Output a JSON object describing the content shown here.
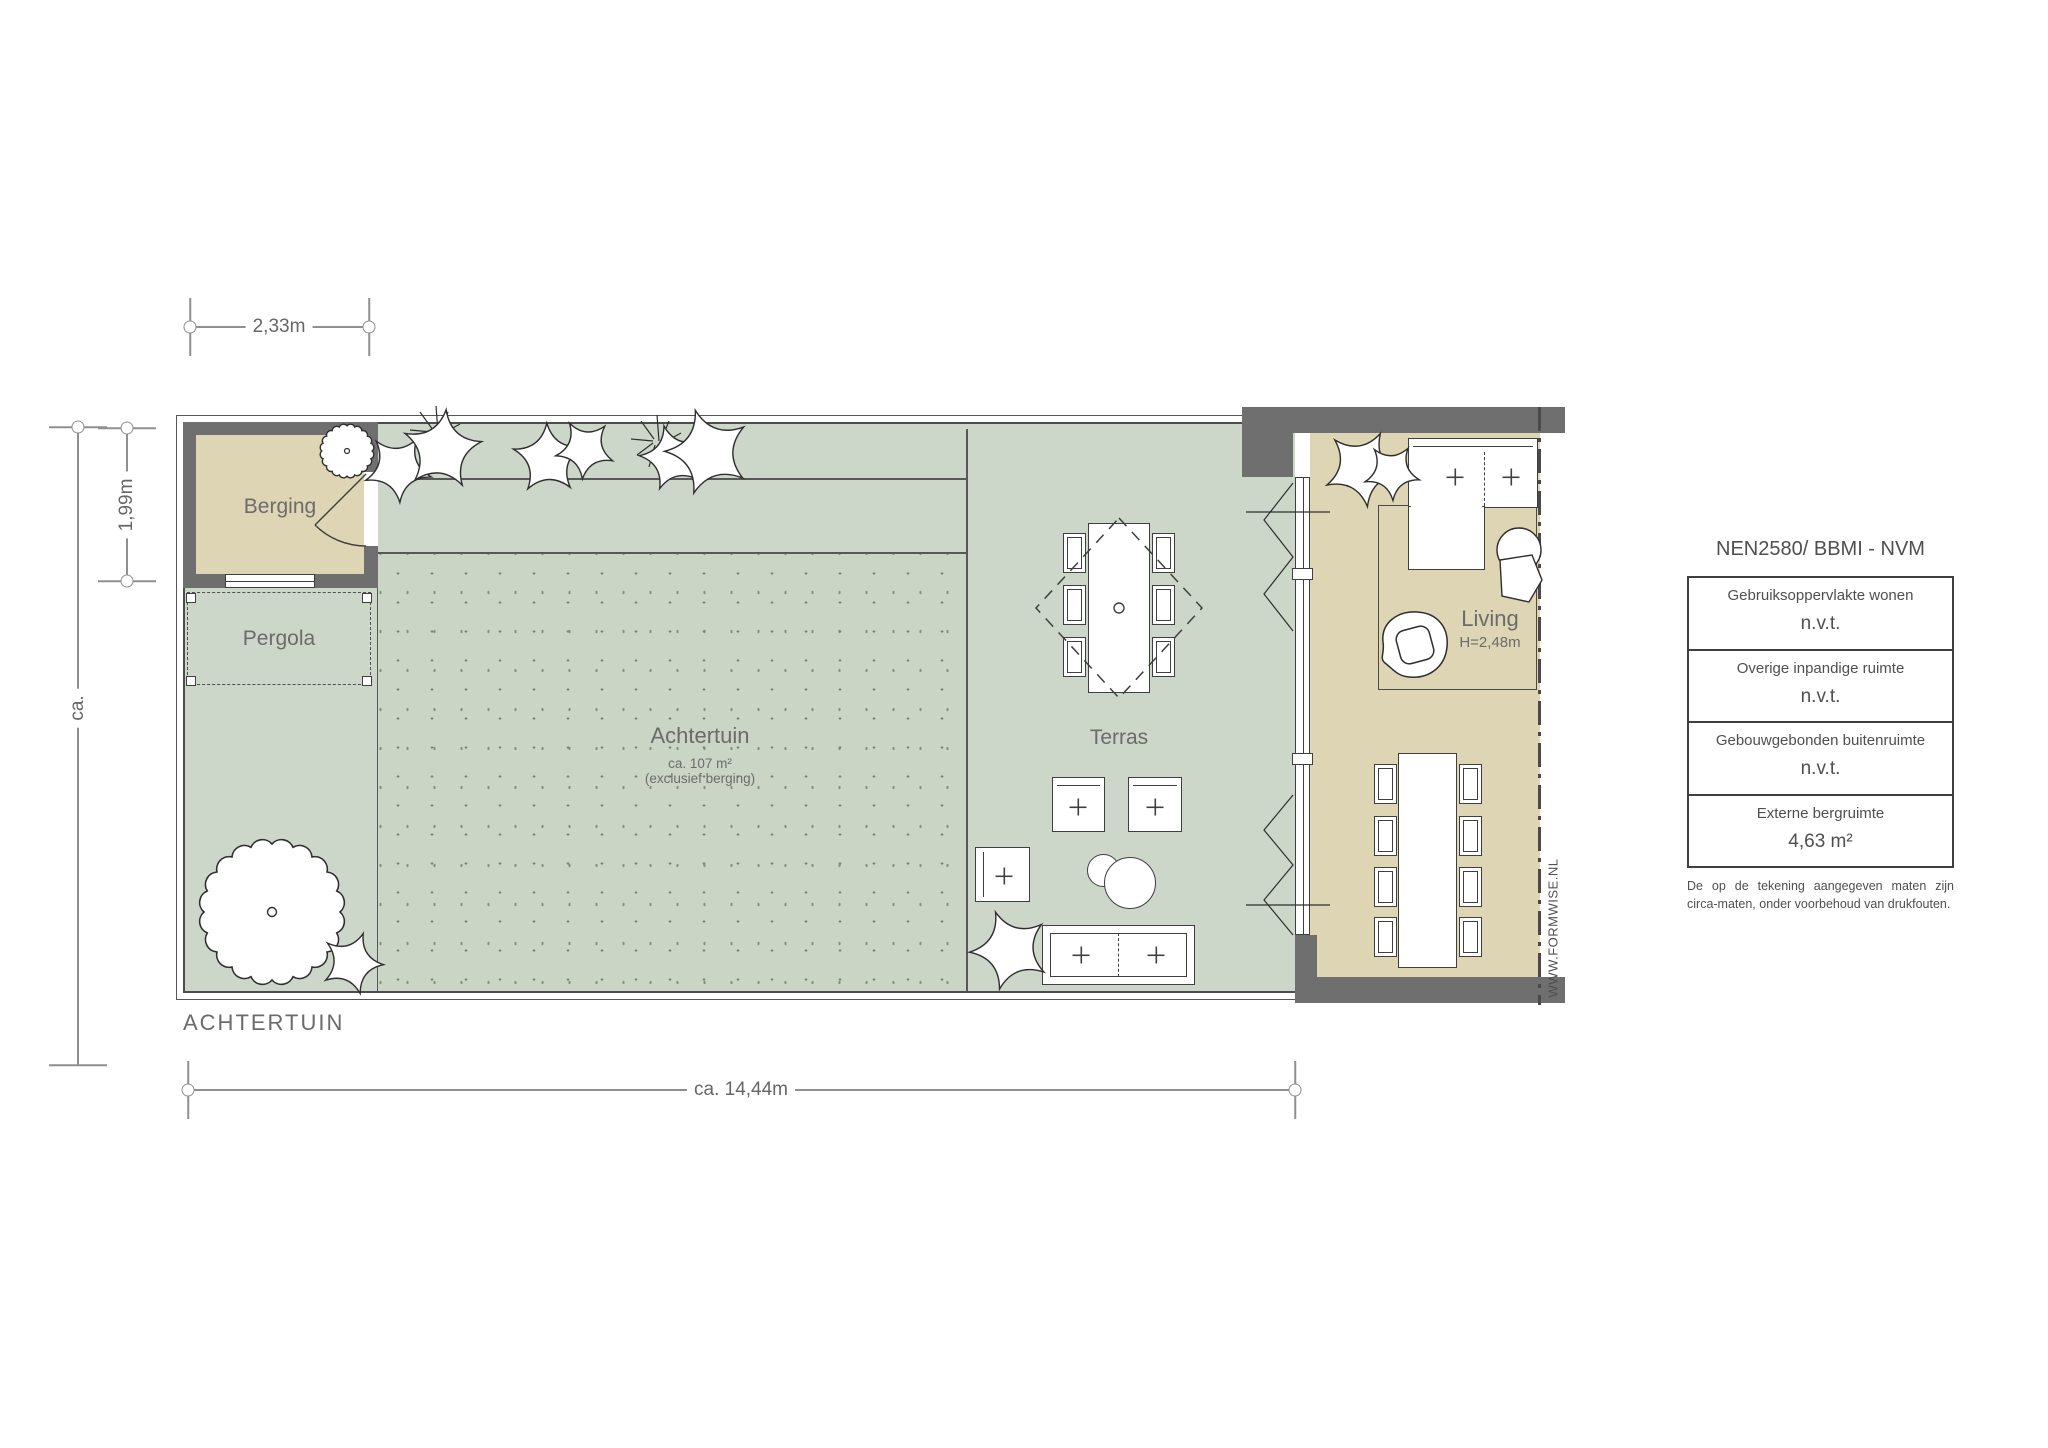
{
  "plan": {
    "title": "ACHTERTUIN",
    "watermark": "WWW.FORMWISE.NL"
  },
  "rooms": {
    "berging": {
      "label": "Berging"
    },
    "pergola": {
      "label": "Pergola"
    },
    "achtertuin": {
      "label": "Achtertuin",
      "area": "ca. 107 m²",
      "note": "(exclusief berging)"
    },
    "terras": {
      "label": "Terras"
    },
    "living": {
      "label": "Living",
      "height": "H=2,48m"
    }
  },
  "dimensions": {
    "top_width": "2,33m",
    "berging_height": "1,99m",
    "left_depth": "ca.",
    "bottom_width": "ca. 14,44m"
  },
  "legend": {
    "title": "NEN2580/ BBMI - NVM",
    "rows": [
      {
        "label": "Gebruiksoppervlakte wonen",
        "value": "n.v.t."
      },
      {
        "label": "Overige inpandige ruimte",
        "value": "n.v.t."
      },
      {
        "label": "Gebouwgebonden buitenruimte",
        "value": "n.v.t."
      },
      {
        "label": "Externe bergruimte",
        "value": "4,63 m²"
      }
    ],
    "footnote": "De op de tekening aangegeven maten zijn circa-maten, onder voorbehoud van drukfouten."
  },
  "colors": {
    "garden_green": "#cdd7c9",
    "floor_tan": "#ded5b4",
    "wall_gray": "#6f6f6f",
    "line_dark": "#3f3f3f",
    "label_gray": "#6b6b6b"
  }
}
